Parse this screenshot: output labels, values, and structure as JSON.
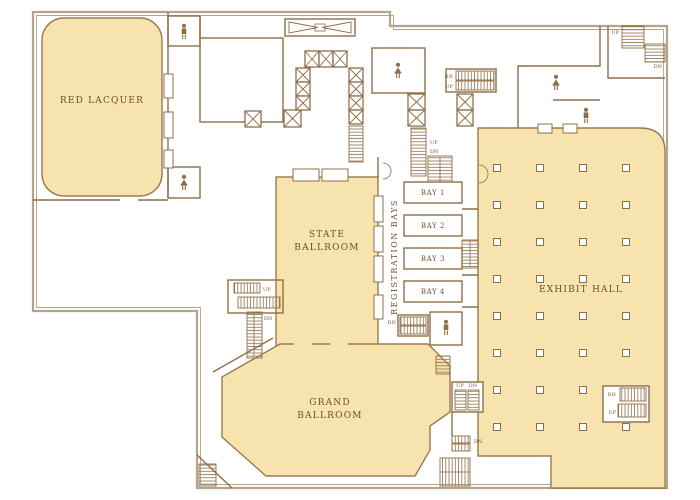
{
  "floor_plan": {
    "rooms": {
      "red_lacquer": "RED LACQUER",
      "state_ballroom": [
        "STATE",
        "BALLROOM"
      ],
      "grand_ballroom": [
        "GRAND",
        "BALLROOM"
      ],
      "exhibit_hall": "EXHIBIT HALL",
      "registration_bays": "REGISTRATION BAYS"
    },
    "bays": [
      "BAY 1",
      "BAY 2",
      "BAY 3",
      "BAY 4"
    ],
    "stair_labels": {
      "up": "UP",
      "dn": "DN"
    },
    "colors": {
      "room_fill": "#f6e3ae",
      "wall": "#8f6f48",
      "outer_wall": "#b3a48c",
      "label_text": "#6e4f30",
      "background": "#ffffff"
    }
  }
}
